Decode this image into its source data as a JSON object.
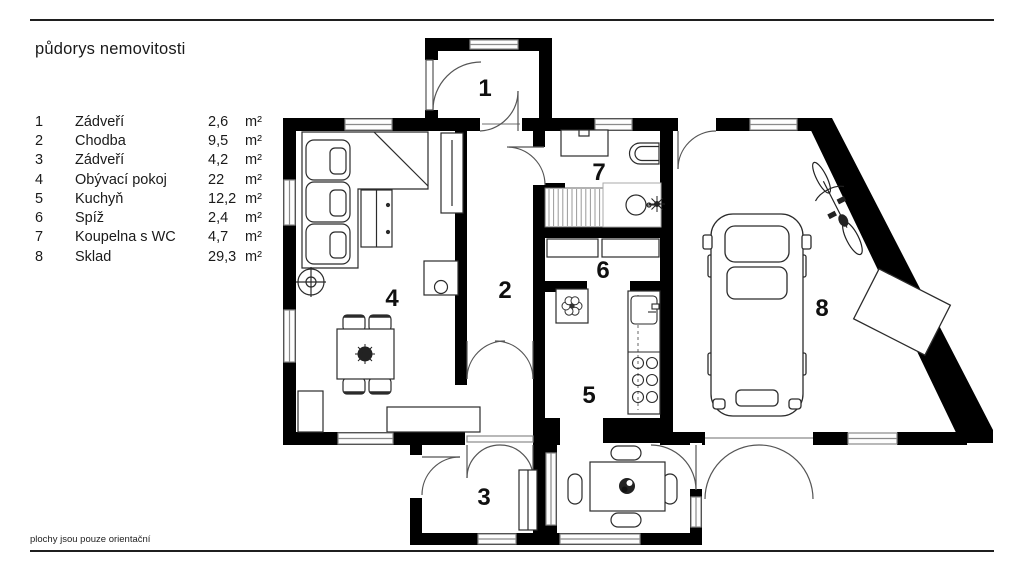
{
  "page": {
    "title": "půdorys nemovitosti",
    "footnote": "plochy jsou pouze orientační"
  },
  "legend": {
    "rows": [
      {
        "number": "1",
        "name": "Zádveří",
        "area": "2,6",
        "unit": "m²"
      },
      {
        "number": "2",
        "name": "Chodba",
        "area": "9,5",
        "unit": "m²"
      },
      {
        "number": "3",
        "name": "Zádveří",
        "area": "4,2",
        "unit": "m²"
      },
      {
        "number": "4",
        "name": "Obývací pokoj",
        "area": "22",
        "unit": "m²"
      },
      {
        "number": "5",
        "name": "Kuchyň",
        "area": "12,2",
        "unit": "m²"
      },
      {
        "number": "6",
        "name": "Spíž",
        "area": "2,4",
        "unit": "m²"
      },
      {
        "number": "7",
        "name": "Koupelna s WC",
        "area": "4,7",
        "unit": "m²"
      },
      {
        "number": "8",
        "name": "Sklad",
        "area": "29,3",
        "unit": "m²"
      }
    ]
  },
  "plan": {
    "room_labels": [
      "1",
      "2",
      "3",
      "4",
      "5",
      "6",
      "7",
      "8"
    ]
  },
  "colors": {
    "wall": "#000000",
    "furniture_line": "#2b2b2b",
    "window_stroke": "#8a8a8a",
    "door_arc": "#555555",
    "text": "#1a1a1a"
  }
}
